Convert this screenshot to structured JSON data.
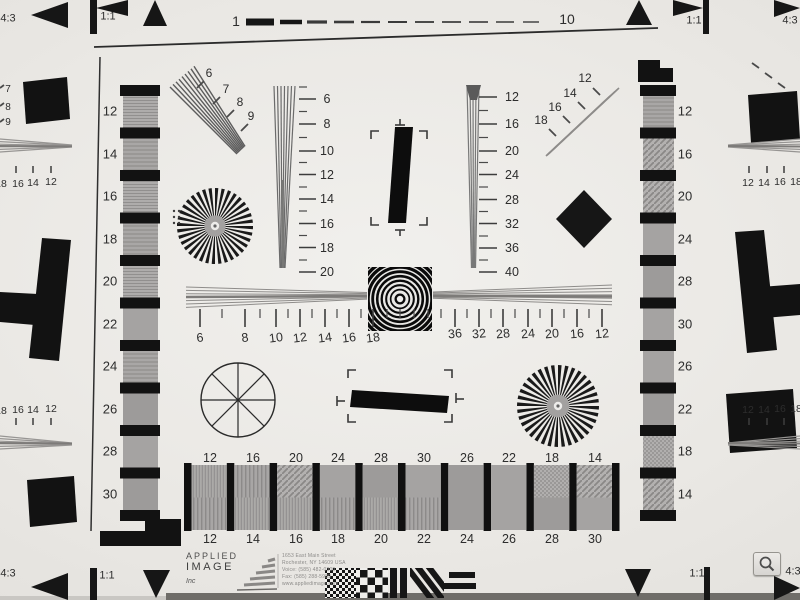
{
  "colors": {
    "paper": "#eae8e4",
    "paper_edge": "#6f6d69",
    "ink": "#161616",
    "wedge_gray": "#8e8c8a",
    "label": "#2d2d2d"
  },
  "top_edge": {
    "left_aspect": "4:3",
    "left_ratio": "1:1",
    "scale_start": "1",
    "scale_end": "10",
    "right_ratio": "1:1",
    "right_aspect": "4:3"
  },
  "bottom_edge": {
    "left_aspect": "4:3",
    "left_ratio": "1:1",
    "right_ratio": "1:1",
    "right_aspect": "4:3"
  },
  "left_strip": {
    "labels": [
      "12",
      "14",
      "16",
      "18",
      "20",
      "22",
      "24",
      "26",
      "28",
      "30"
    ]
  },
  "right_strip": {
    "labels": [
      "12",
      "16",
      "20",
      "24",
      "28",
      "30",
      "26",
      "22",
      "18",
      "14"
    ]
  },
  "upper_left_wedge": {
    "labels": [
      "6",
      "7",
      "8",
      "9"
    ]
  },
  "upper_right_wedge": {
    "labels": [
      "12",
      "14",
      "16",
      "18"
    ]
  },
  "center_left_scale": {
    "labels": [
      "6",
      "8",
      "10",
      "12",
      "14",
      "16",
      "18",
      "20"
    ]
  },
  "center_right_scale": {
    "labels": [
      "12",
      "16",
      "20",
      "24",
      "28",
      "32",
      "36",
      "40"
    ]
  },
  "horizontal_scale": {
    "left_labels": [
      "6",
      "8",
      "10",
      "12",
      "14",
      "16",
      "18"
    ],
    "right_labels": [
      "36",
      "32",
      "28",
      "24",
      "20",
      "16",
      "12"
    ]
  },
  "bottom_strip": {
    "top_labels": [
      "12",
      "16",
      "20",
      "24",
      "28",
      "30",
      "26",
      "22",
      "18",
      "14"
    ],
    "bottom_labels": [
      "12",
      "14",
      "16",
      "18",
      "20",
      "22",
      "24",
      "26",
      "28",
      "30"
    ]
  },
  "edge_rulers": {
    "left_top": [
      "18",
      "16",
      "14",
      "12"
    ],
    "left_bottom": [
      "18",
      "16",
      "14",
      "12"
    ],
    "right_top": [
      "12",
      "14",
      "16",
      "18"
    ],
    "right_bottom": [
      "12",
      "14",
      "16",
      "18"
    ]
  },
  "left_edge_wedge": {
    "labels": [
      "7",
      "8",
      "9"
    ]
  },
  "logo": {
    "line1": "APPLIED",
    "line2": "IMAGE",
    "line3": "Inc",
    "address": [
      "1653 East Main Street",
      "Rochester, NY 14609 USA",
      "Voice: (585) 482-0300",
      "Fax: (585) 288-5989",
      "www.appliedimage.com"
    ]
  },
  "viewer": {
    "zoom_icon": "magnifier"
  }
}
